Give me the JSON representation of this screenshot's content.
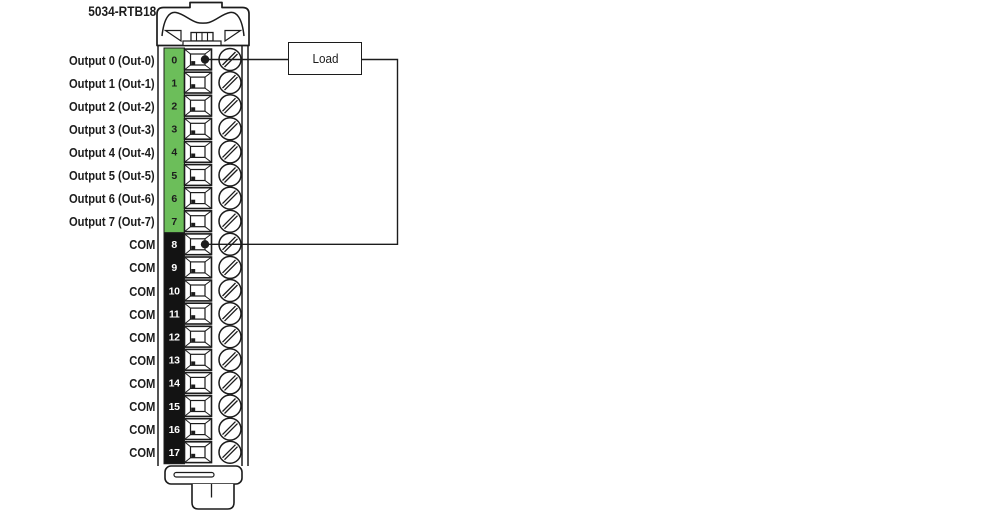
{
  "title": "5034-RTB18",
  "load": {
    "label": "Load"
  },
  "colors": {
    "green": "#6cbe5a",
    "com_black": "#131313",
    "line": "#1c1c1c",
    "text": "#1c1c1c",
    "background": "#ffffff"
  },
  "terminals": [
    {
      "num": "0",
      "label": "Output 0 (Out-0)",
      "group": "output",
      "wired": true
    },
    {
      "num": "1",
      "label": "Output 1 (Out-1)",
      "group": "output",
      "wired": false
    },
    {
      "num": "2",
      "label": "Output 2 (Out-2)",
      "group": "output",
      "wired": false
    },
    {
      "num": "3",
      "label": "Output 3 (Out-3)",
      "group": "output",
      "wired": false
    },
    {
      "num": "4",
      "label": "Output 4 (Out-4)",
      "group": "output",
      "wired": false
    },
    {
      "num": "5",
      "label": "Output 5 (Out-5)",
      "group": "output",
      "wired": false
    },
    {
      "num": "6",
      "label": "Output 6 (Out-6)",
      "group": "output",
      "wired": false
    },
    {
      "num": "7",
      "label": "Output 7 (Out-7)",
      "group": "output",
      "wired": false
    },
    {
      "num": "8",
      "label": "COM",
      "group": "com",
      "wired": true
    },
    {
      "num": "9",
      "label": "COM",
      "group": "com",
      "wired": false
    },
    {
      "num": "10",
      "label": "COM",
      "group": "com",
      "wired": false
    },
    {
      "num": "11",
      "label": "COM",
      "group": "com",
      "wired": false
    },
    {
      "num": "12",
      "label": "COM",
      "group": "com",
      "wired": false
    },
    {
      "num": "13",
      "label": "COM",
      "group": "com",
      "wired": false
    },
    {
      "num": "14",
      "label": "COM",
      "group": "com",
      "wired": false
    },
    {
      "num": "15",
      "label": "COM",
      "group": "com",
      "wired": false
    },
    {
      "num": "16",
      "label": "COM",
      "group": "com",
      "wired": false
    },
    {
      "num": "17",
      "label": "COM",
      "group": "com",
      "wired": false
    }
  ]
}
